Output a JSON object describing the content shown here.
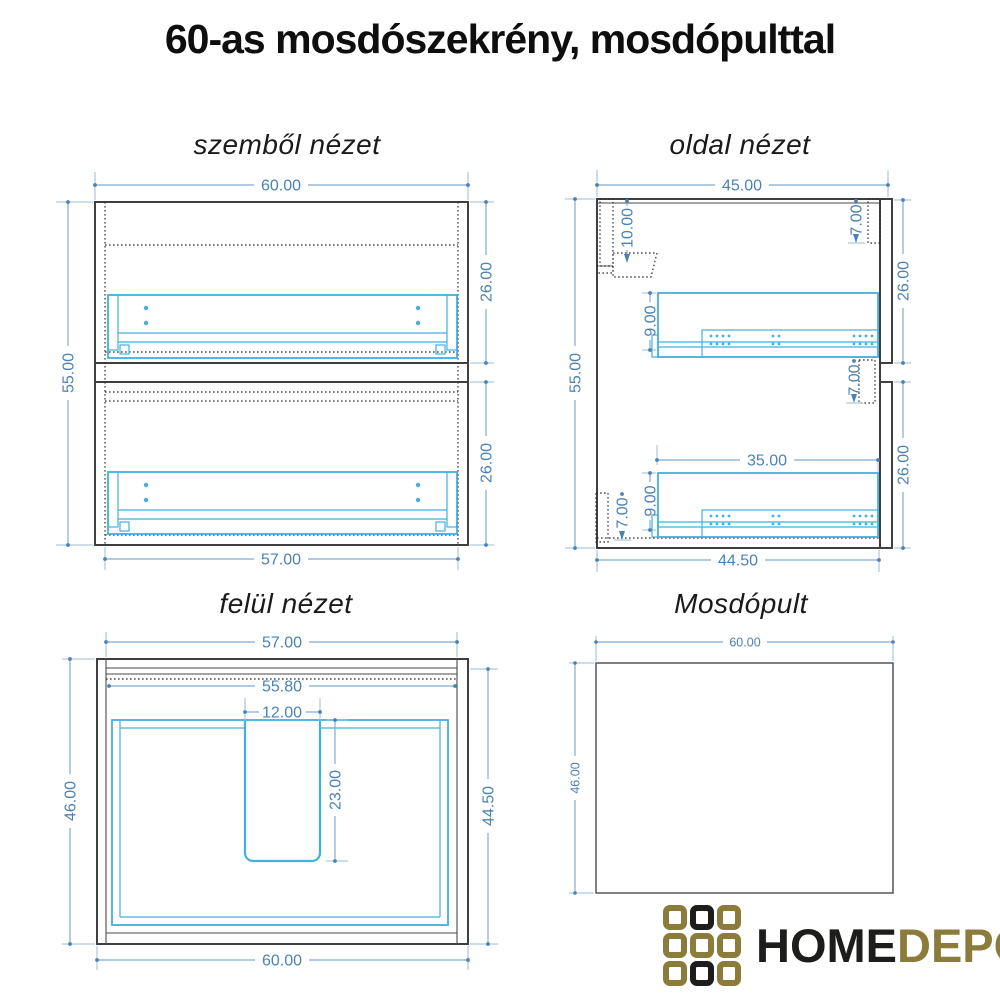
{
  "title": "60-as mosdószekrény, mosdópulttal",
  "views": {
    "front": {
      "label": "szemből nézet",
      "dims": {
        "width_top": "60.00",
        "height": "55.00",
        "drawer_upper": "26.00",
        "drawer_lower": "26.00",
        "width_bottom": "57.00"
      }
    },
    "side": {
      "label": "oldal nézet",
      "dims": {
        "depth_top": "45.00",
        "height": "55.00",
        "hang_rail_offset": "10.00",
        "front_gap_top": "7.00",
        "front_gap_mid": "7.00",
        "back_gap_bottom": "7.00",
        "slide_offset_upper": "9.00",
        "slide_offset_lower": "9.00",
        "slide_length": "35.00",
        "front_upper": "26.00",
        "front_lower": "26.00",
        "depth_bottom": "44.50"
      }
    },
    "top": {
      "label": "felül nézet",
      "dims": {
        "width_top": "57.00",
        "inner_width": "55.80",
        "cutout_width": "12.00",
        "cutout_depth": "23.00",
        "depth_left": "46.00",
        "depth_right": "44.50",
        "width_bottom": "60.00"
      }
    },
    "counter": {
      "label": "Mosdópult",
      "dims": {
        "width": "60.00",
        "depth": "46.00"
      }
    }
  },
  "logo": {
    "home": "HOME",
    "depo": "DEPO",
    "gold_color": "#8c7c3c",
    "black_color": "#1d1d1b"
  },
  "colors": {
    "drawing_line": "#3f3f3f",
    "hardware_cyan": "#41b1df",
    "dimension_line": "#85abcd",
    "dimension_text": "#4b82b4"
  }
}
